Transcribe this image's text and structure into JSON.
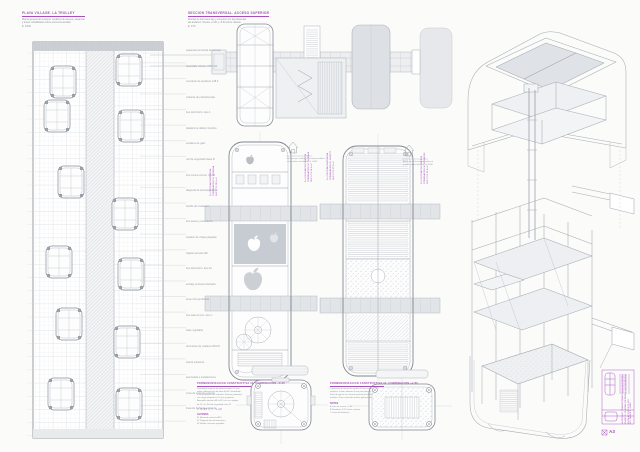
{
  "colors": {
    "paper": "#fbfbfa",
    "ink": "#868d96",
    "ink_light": "#b0b5bb",
    "fill_light": "#eceef0",
    "fill_mid": "#c7ccd2",
    "accent": "#a64fba"
  },
  "icons": {
    "house_left": "house-icon",
    "house_right": "house-icon",
    "corner_bolt": "corner-bolt-icon",
    "apple_logo": "apple-logo-icon"
  },
  "titles": {
    "left": {
      "heading": "PLAYA VILLAGE. LA TROLLEY",
      "line1": "Planta general del conjunto. Andamio de acceso, pasarelas",
      "line2": "y buses rehabilitados sobre estructura auxiliar.",
      "scale": "E: 1/200"
    },
    "middle": {
      "heading": "SECCION TRANSVERSAL. ACCESO SUPERIOR",
      "line1": "Plantas de los buses tipo y conexion con las pasarelas",
      "line2": "del andamio. Niveles +2.80 y +5.60 sobre rasante.",
      "scale": "E: 1/75"
    }
  },
  "left_plan": {
    "labels": [
      "pasarela perimetral de acceso",
      "barandilla tubular o48 h110",
      "montante de andamio o48.3",
      "cubierta de policarbonato",
      "bus dormitorio. tipo A",
      "plataforma tablero fenolico",
      "escalera de gato",
      "red de seguridad clase B",
      "bus cocina comun. tipo B",
      "diagonal de arriostramiento",
      "husillo de nivelacion",
      "bus aseos y lavanderia",
      "canalon de chapa plegada",
      "bajante pluvial o90",
      "bus dormitorio. tipo A2",
      "anclaje puntual a fachada",
      "lona microperforada",
      "bus sala comun. tipo C",
      "base regulable",
      "durmiente de madera 200x70",
      "solera existente",
      "acometida e instalaciones",
      "zona de estancia exterior",
      "linea de fachada existente"
    ]
  },
  "mid": {
    "left_caption": [
      "Acceso por cubierta. Pasarela metalica",
      "conectada al andamio. E 1/400"
    ],
    "right_caption": [
      "Apertura de lucernario sobre el",
      "pasillo central del bus. E 1/400"
    ],
    "strips": {
      "s1": [
        "N +2.80 PLANTA PRIMERA",
        "COMBINACION 01. VIVIENDA",
        "SUP. UTIL 28,5 m2"
      ],
      "s2": [
        "N +5.60 PLANTA CUBIERTA",
        "COMBINACION 02. TERRAZA",
        "SUP. UTIL 26,0 m2"
      ],
      "s3": [
        "N +2.80 PLANTA PRIMERA",
        "COMBINACION 03. HUERTO",
        "SUP. UTIL 27,2 m2"
      ],
      "s4": [
        "N +5.60 PLANTA CUBIERTA",
        "COMBINACION 04. SOLARIUM",
        "SUP. UTIL 25,4 m2"
      ]
    }
  },
  "details": {
    "left": {
      "heading": "PORMENORIZACION CONSTRUCTIVA 01. COMBINACION +0.00",
      "body": [
        "Plataforma superior de tablero fenolico 22 mm",
        "sobre subestructura de tubo 40.40.2 atornillada",
        "a los montantes del andamio. Remate perimetral",
        "con chapa plegada e=1,5 mm y goteron.",
        "Barandilla tubular o48 h=110 cm con rodapie",
        "de 15 cm. Red de seguridad clase B."
      ],
      "symbols": "◇ 0.45 ◇   ▷ 1.20",
      "subheading": "LEYENDA",
      "body2": [
        "01 Montante vertical o48.3",
        "02 Diagonal de arriostramiento",
        "03 Husillo con base regulable"
      ]
    },
    "right": {
      "heading": "PORMENORIZACION CONSTRUCTIVA 02. COMBINACION +2.80",
      "body": [
        "Pavimento de tarima de madera 28 mm sobre",
        "rastreles. Juntas abiertas 8 mm para drenaje.",
        "Zona de gravas con lamina geotextil y bordillo",
        "metalico. Paso central de tramex galvanizado."
      ],
      "subheading": "NOTAS",
      "body2": [
        "A Cota de acceso +2.80",
        "B Pendiente 1,5% hacia canalon",
        "C Junta de dilatacion"
      ]
    }
  },
  "titleblock": {
    "lines": [
      "LA TROLLEY. TRANSFORMACION DE AUTOBUSES",
      "PLANO 07. PLANTAS, DETALLES Y AXONOMETRIA",
      "ESCALAS 1/200 1/75 1/20",
      "PFC TALLER 2. JUNIO"
    ],
    "mark": "A3"
  }
}
